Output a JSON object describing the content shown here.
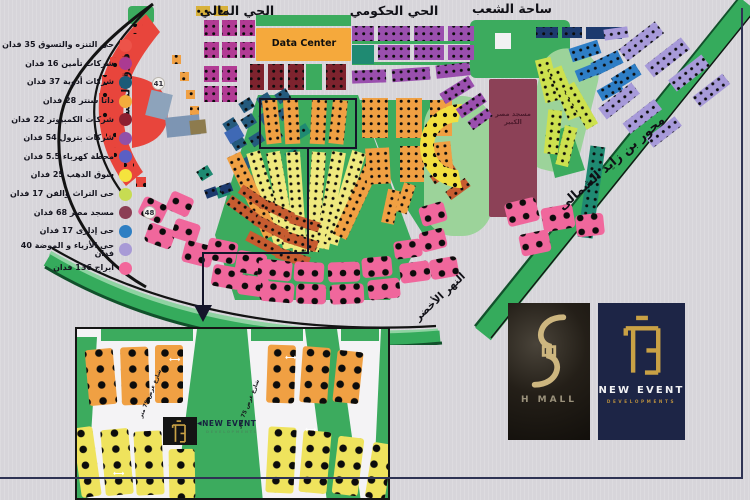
{
  "page": {
    "background": "#d7d5da",
    "frame_color": "#2e3354"
  },
  "legend": {
    "items": [
      {
        "label": "حى التنزه والتسوق 35 فدان",
        "color": "#ed5349"
      },
      {
        "label": "شركات تأمين 16 فدان",
        "color": "#ab3a92"
      },
      {
        "label": "شركات أدوية 37 فدان",
        "color": "#1c5b78"
      },
      {
        "label": "داتا سنتر 28 فدان",
        "color": "#f3ac3c"
      },
      {
        "label": "شركات الكمبيوتر 22 فدان",
        "color": "#8c2030"
      },
      {
        "label": "شركات بترول 54 فدان",
        "color": "#9150a8"
      },
      {
        "label": "محطة كهرباء 5.5 فدان",
        "color": "#5a5fc4"
      },
      {
        "label": "سوق الدهب 25 فدان",
        "color": "#f5e33d"
      },
      {
        "label": "حى التراث والفن 17 فدان",
        "color": "#c7dc52"
      },
      {
        "label": "مسجد مصر 68 فدان",
        "color": "#8c3e55"
      },
      {
        "label": "حى إدارى 17 فدان",
        "color": "#2f7fc3"
      },
      {
        "label": "حى الأزياء و الموضة 40 فدان",
        "color": "#a89ad6"
      },
      {
        "label": "أبراج 136 فدان",
        "color": "#f2679b"
      }
    ]
  },
  "map": {
    "districts": {
      "financial": "الحي المالي",
      "governmental": "الحي الحكومي",
      "peoples_square": "ساحة الشعب"
    },
    "labels": {
      "hotel": "فندق الماسة",
      "axis_road": "محور بن زايد الشمالى",
      "green_river": "النهر الأخضر",
      "data_center": "Data Center",
      "grand_mosque": "مسجد مصر\nالكبير",
      "road_badge_41": "41",
      "road_badge_48": "48"
    }
  },
  "inset": {
    "street_label": "شارع عرض 75 متر",
    "dim_arrow": "⟷",
    "logo": {
      "arrow": "◀",
      "brand": "NEW EVENT",
      "sub": "DEVELOPMENTS"
    }
  },
  "logos": {
    "h_mall": {
      "title": "H MALL"
    },
    "new_event": {
      "title": "NEW EVENT",
      "subtitle": "DEVELOPMENTS"
    }
  }
}
